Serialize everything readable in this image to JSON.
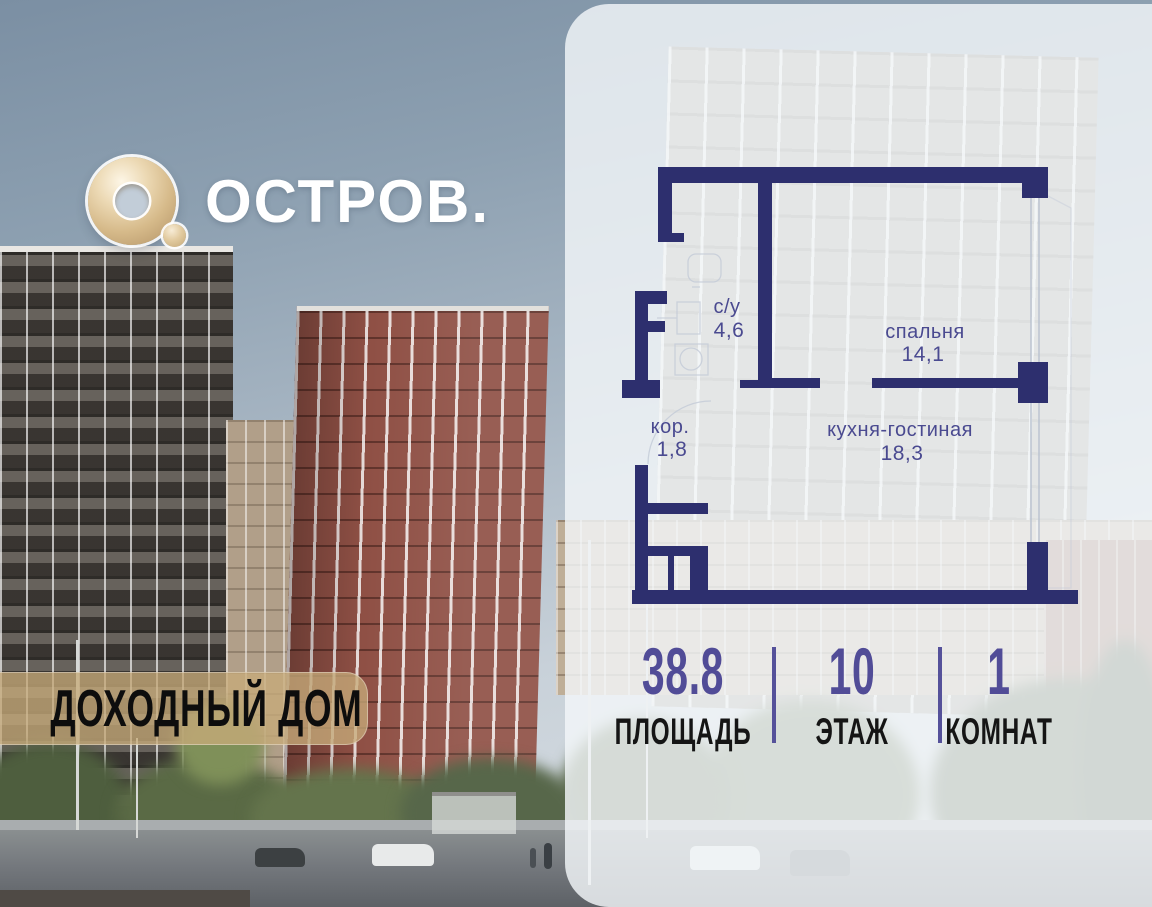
{
  "brand": {
    "logo_text": "ОСТРОВ.",
    "badge": "ДОХОДНЫЙ ДОМ"
  },
  "floor_plan": {
    "rooms": [
      {
        "name": "с/у",
        "area": "4,6"
      },
      {
        "name": "спальня",
        "area": "14,1"
      },
      {
        "name": "кор.",
        "area": "1,8"
      },
      {
        "name": "кухня-гостиная",
        "area": "18,3"
      }
    ]
  },
  "stats": [
    {
      "value": "38.8",
      "label": "ПЛОЩАДЬ"
    },
    {
      "value": "10",
      "label": "ЭТАЖ"
    },
    {
      "value": "1",
      "label": "КОМНАТ"
    }
  ],
  "colors": {
    "wall_navy": "#2d2f6e",
    "room_label_indigo": "#4a4a90",
    "stat_value_purple": "#514c97",
    "stat_label_black": "#151515",
    "badge_gold": "#c7ab7a",
    "logo_gold": "#d6ba8a"
  }
}
